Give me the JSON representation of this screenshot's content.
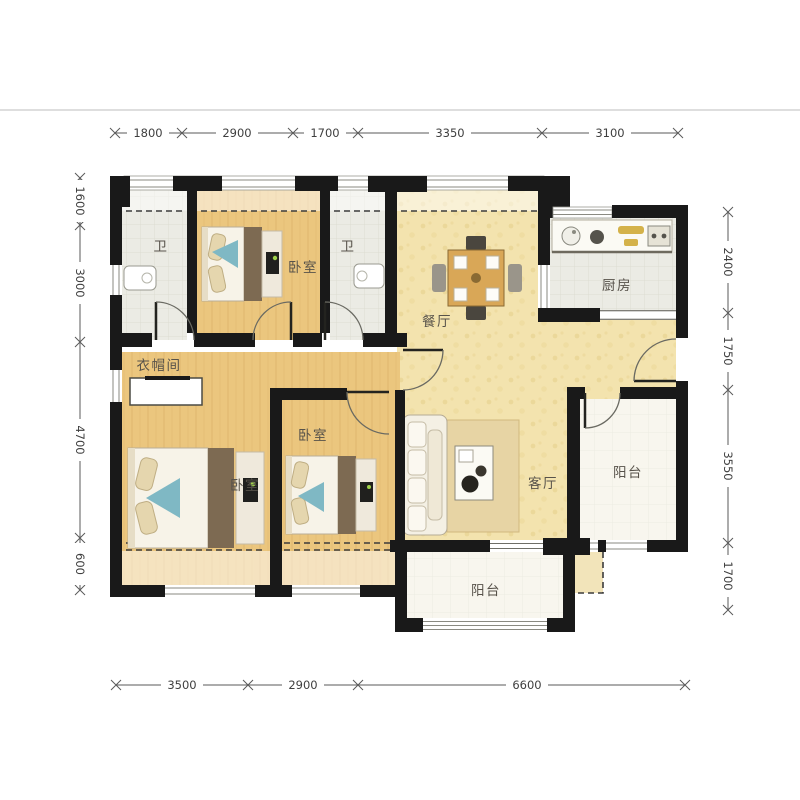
{
  "meta": {
    "type": "apartment-floor-plan"
  },
  "rooms": {
    "bathroom_1": "卫",
    "bedroom_north": "卧室",
    "bathroom_2": "卫",
    "cloakroom": "衣帽间",
    "master_bedroom": "卧室",
    "bedroom_second": "卧室",
    "dining_room": "餐厅",
    "kitchen": "厨房",
    "living_room": "客厅",
    "balcony_east": "阳台",
    "balcony_south": "阳台"
  },
  "dimensions_mm": {
    "top": [
      "1800",
      "2900",
      "1700",
      "3350",
      "3100"
    ],
    "bottom": [
      "3500",
      "2900",
      "6600"
    ],
    "left": [
      "1600",
      "3000",
      "4700",
      "600"
    ],
    "right": [
      "2400",
      "1750",
      "3550",
      "1700"
    ]
  },
  "colors": {
    "wall": "#191919",
    "wood_floor": "#ebc67e",
    "hall_floor": "#f3e3ae",
    "tile_floor": "#ebebe6",
    "balcony_floor": "#f8f6ef",
    "accent_blue": "#7fb8c4",
    "rug": "#e7d4a4",
    "table_wood": "#d9a757",
    "dim_text": "#3f3f3f",
    "label_text": "#57524a"
  }
}
